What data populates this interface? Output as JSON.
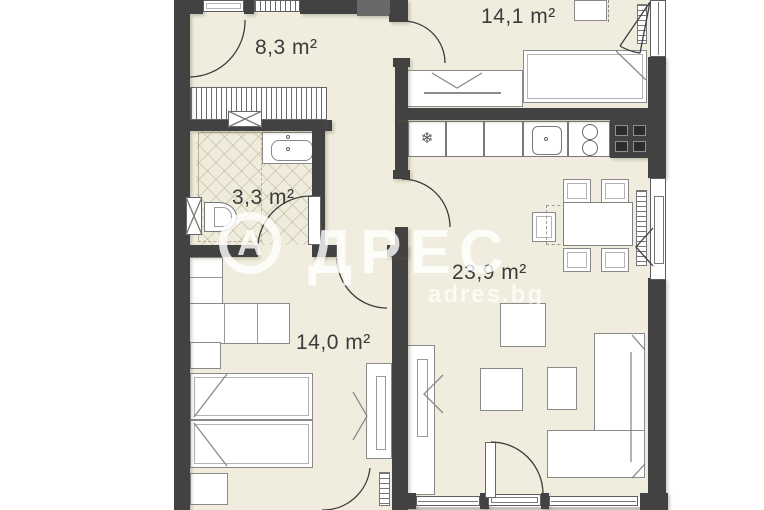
{
  "plan": {
    "rooms": [
      {
        "id": "hallway",
        "area_label": "8,3 m²"
      },
      {
        "id": "bedroom-top",
        "area_label": "14,1 m²"
      },
      {
        "id": "bathroom",
        "area_label": "3,3 m²"
      },
      {
        "id": "living-room",
        "area_label": "23,9 m²"
      },
      {
        "id": "bedroom-bottom",
        "area_label": "14,0 m²"
      }
    ]
  },
  "watermark": {
    "logo_letter": "А",
    "brand_rest": "ДРЕС",
    "domain": "adres.bg"
  },
  "icons": {
    "fridge_snowflake": "❄"
  },
  "colors": {
    "floor": "#f0edde",
    "wall": "#424242",
    "background": "#ffffff",
    "label_text": "#3b3b3b",
    "watermark": "rgba(255,255,255,0.8)"
  }
}
